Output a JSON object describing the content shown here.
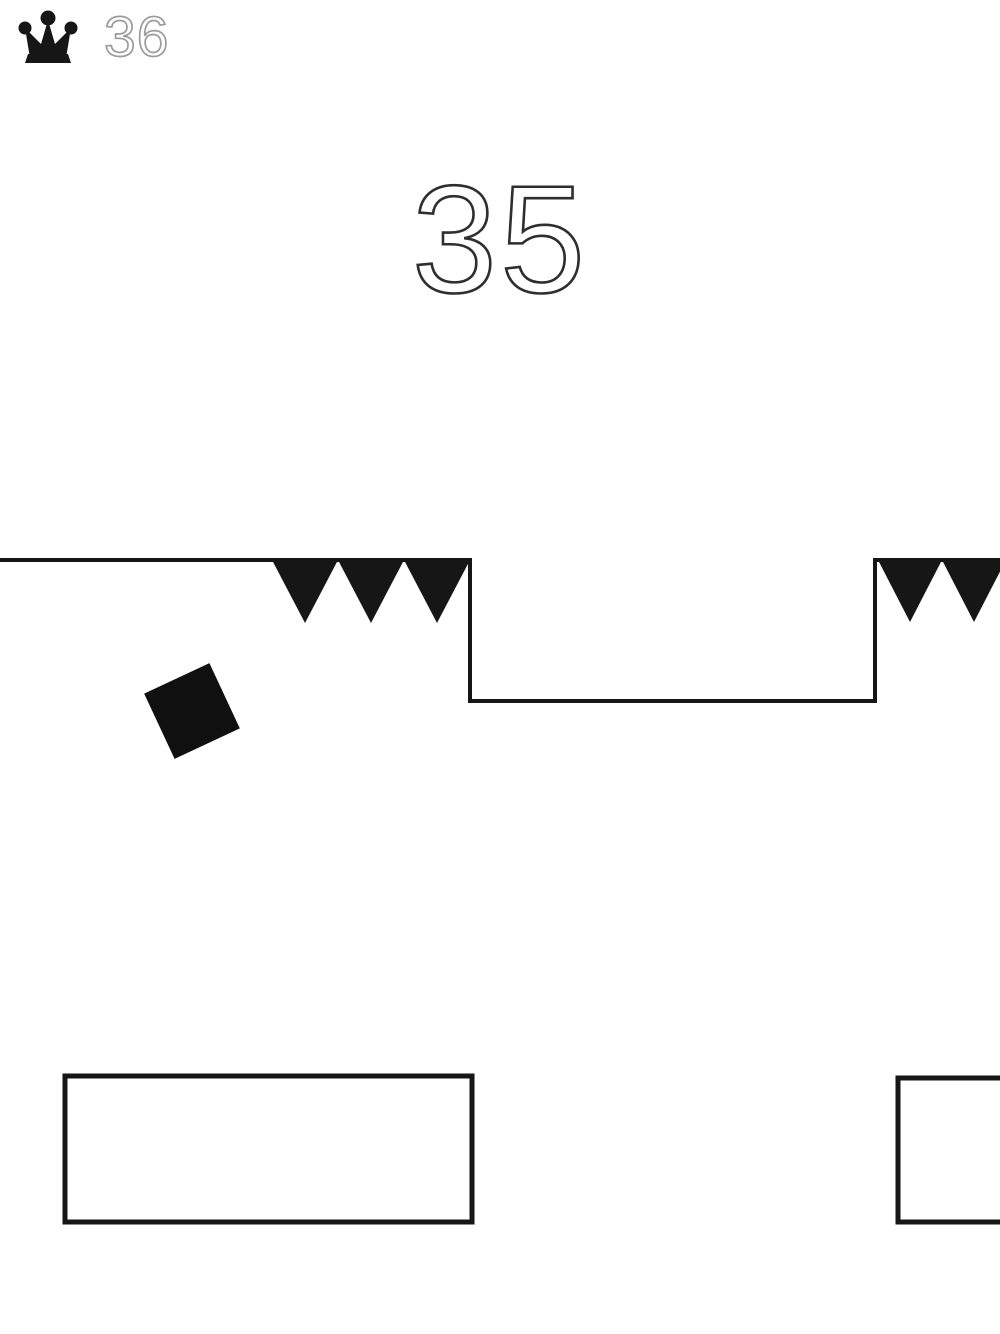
{
  "meta": {
    "type": "minimal-endless-runner-game-screen"
  },
  "colors": {
    "background": "#ffffff",
    "ink": "#161616",
    "player": "#101010",
    "best_score_gray": "#9b9b9b",
    "score_dark": "#2e2e2e"
  },
  "hud": {
    "crown_icon": "crown-icon",
    "best_score": "36",
    "current_score": "35"
  },
  "scene": {
    "width": 1000,
    "height": 1334,
    "line_width": 4,
    "ground": {
      "path": "M0,560 H470 V701 H875 V560 H1002",
      "top_y": 560,
      "lower_y": 701,
      "step_down_x": 470,
      "step_up_x": 875
    },
    "spike_groups": [
      {
        "x_start": 272,
        "x_end": 470,
        "count": 3,
        "base_y": 560,
        "tip_y": 623
      },
      {
        "x_start": 878,
        "x_end": 1006,
        "count": 2,
        "base_y": 560,
        "tip_y": 622
      }
    ],
    "player": {
      "cx": 192,
      "cy": 711,
      "size": 72,
      "rotation_deg": -25
    },
    "obstacle_stroke": 5,
    "obstacles": [
      {
        "x": 65,
        "y": 1076,
        "width": 407,
        "height": 146
      },
      {
        "x": 898,
        "y": 1078,
        "width": 150,
        "height": 144
      }
    ]
  }
}
